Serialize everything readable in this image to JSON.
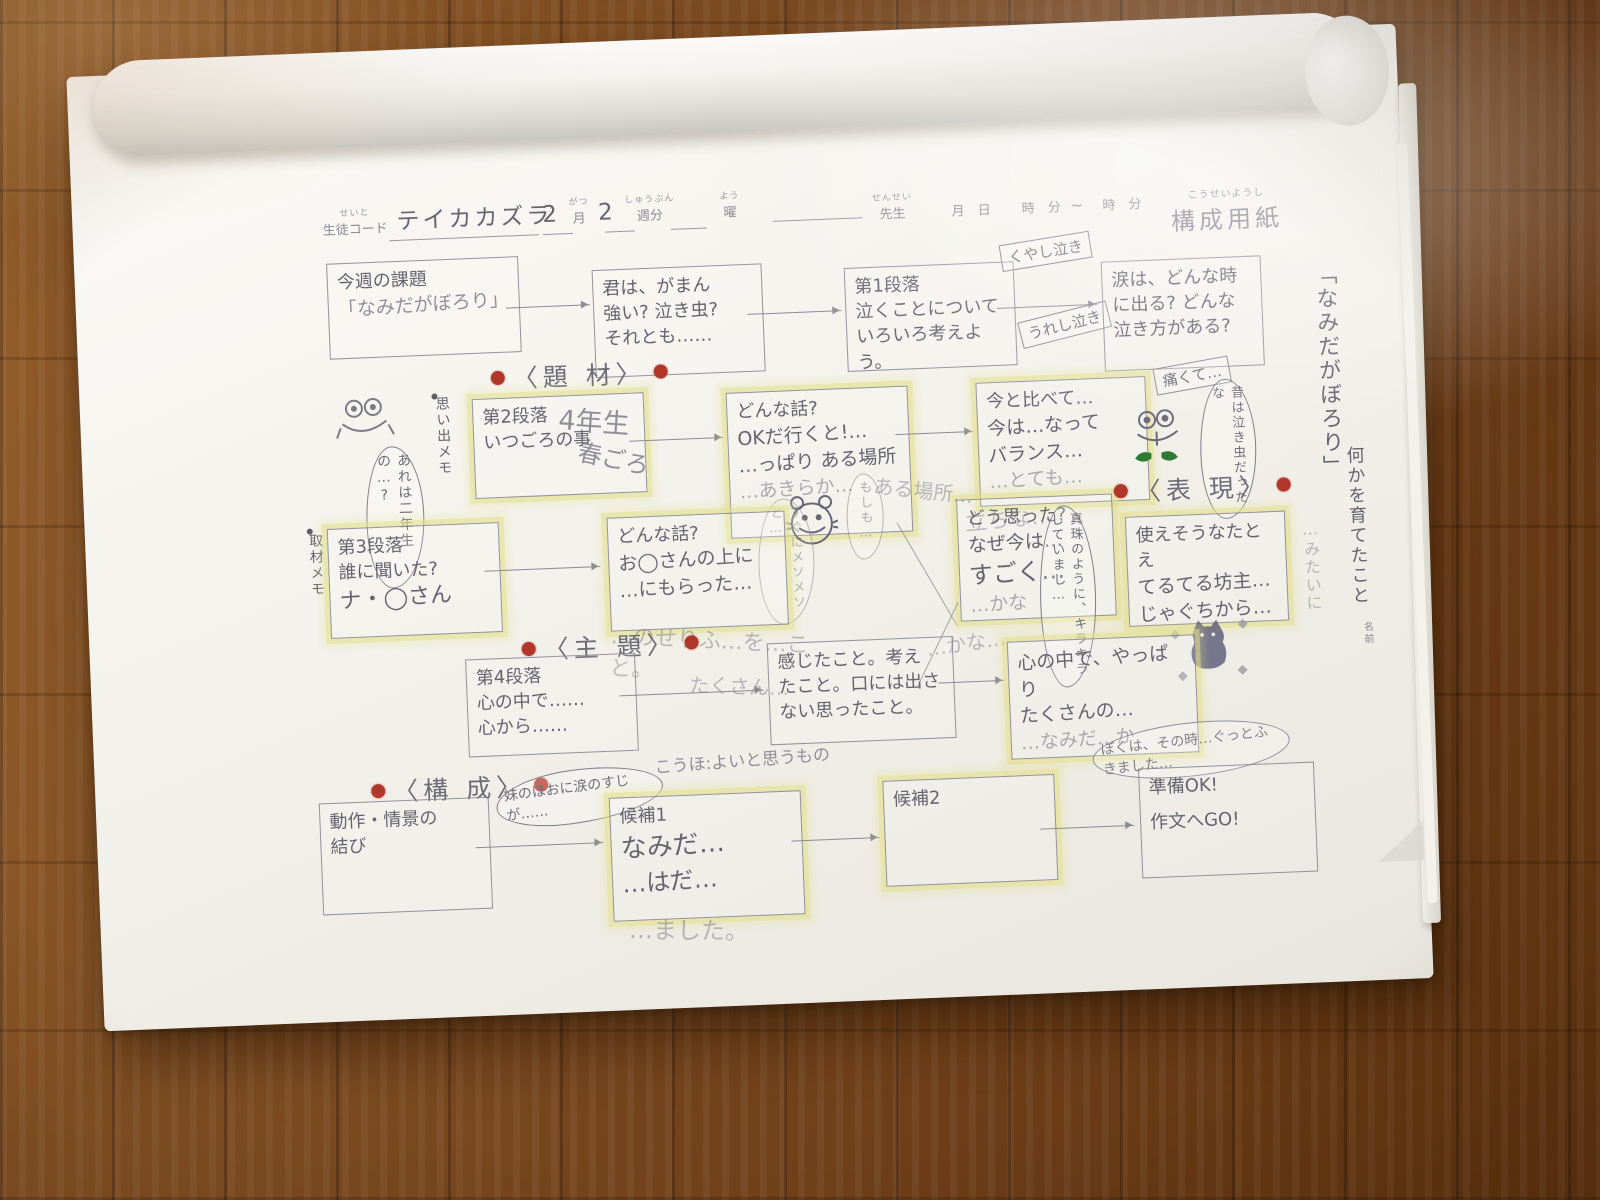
{
  "colors": {
    "highlight_yellow": "#e4e08c",
    "red_dot": "#b2372b",
    "pencil_gray": "#7e7e89",
    "pen_gray": "#64646f",
    "leaf_green": "#2f7a33",
    "cat_blue": "#5c5c78",
    "paper": "#f4f2ec",
    "wood": "#7c4a20"
  },
  "header": {
    "student_code_ruby": "せいと",
    "student_code_label": "生徒コード",
    "student_code_value": "テイカカズラ",
    "month_value": "2",
    "month_ruby": "がつ",
    "month_label": "月",
    "week_value": "2",
    "week_ruby": "しゅうぶん",
    "week_label": "週分",
    "day_ruby": "よう",
    "day_label": "曜",
    "teacher_ruby": "せんせい",
    "teacher_label": "先生",
    "m2_label": "月",
    "d2_label": "日",
    "h1_label": "時",
    "min1_label": "分",
    "tilde": "~",
    "h2_label": "時",
    "min2_label": "分",
    "sheet_title_ruby": "こうせいようし",
    "sheet_title": "構成用紙"
  },
  "sections": {
    "daizai": "〈題 材〉",
    "shudai": "〈主 題〉",
    "hyogen": "〈表 現〉",
    "kousei": "〈構 成〉"
  },
  "margins": {
    "omoide_memo": "思い出メモ",
    "shuzai_memo": "取材メモ",
    "title_vertical": "「なみだがぼろり」",
    "subtitle_vertical": "何かを育てたこと",
    "margin_pencil": "…みたいに",
    "name_label": "名前"
  },
  "boxes": {
    "b1": {
      "l1": "今週の課題",
      "l2": "「なみだがぼろり」"
    },
    "b2": {
      "l1": "君は、がまん",
      "l2": "強い? 泣き虫?",
      "l3": "それとも……"
    },
    "b3": {
      "l1": "第1段落",
      "l2": "泣くことについて",
      "l3": "いろいろ考えよう。"
    },
    "b4": {
      "l1": "涙は、どんな時",
      "l2": "に出る? どんな",
      "l3": "泣き方がある?"
    },
    "b5": {
      "l1": "第2段落",
      "l2": "いつごろの事",
      "p1": "4年生",
      "p2": "春ごろ"
    },
    "b6": {
      "l1": "どんな話?",
      "p1": "OKだ行くと!…",
      "p2": "…っぱり ある場所",
      "p3": "…あきらか…"
    },
    "b7": {
      "l1": "今と比べて…",
      "p1": "今は…なって",
      "p2": "バランス…",
      "p3": "…とても…",
      "under": "立ちな…"
    },
    "b8": {
      "l1": "第3段落",
      "l2": "誰に聞いた?",
      "p1": "ナ・◯さん"
    },
    "b9": {
      "l1": "どんな話?",
      "p1": "お◯さんの上に",
      "p2": "…にもらった…",
      "under": "…のせりふ…を…こと。"
    },
    "b10": {
      "l1": "どう思った?",
      "p1": "なぜ今は…",
      "p2": "すごく…",
      "p3": "…かな"
    },
    "b11": {
      "l1": "使えそうなたとえ",
      "p1": "てるてる坊主…",
      "p2": "じゃぐちから…"
    },
    "b12": {
      "l1": "第4段落",
      "l2": "心の中で……",
      "l3": "心から……"
    },
    "b13": {
      "l1": "感じたこと。考え",
      "l2": "たこと。口には出さ",
      "l3": "ない思ったこと。"
    },
    "b14": {
      "p1": "心の中で、やっぱり",
      "p2": "たくさんの…",
      "p3": "…なみだ…か"
    },
    "b15": {
      "l1": "動作・情景の",
      "l2": "結び"
    },
    "b16": {
      "l1": "候補1",
      "p1": "なみだ…",
      "p2": "…はだ…",
      "under": "…ました。"
    },
    "b17": {
      "l1": "候補2"
    },
    "b18": {
      "l1": "準備OK!",
      "l2": "作文へGO!"
    }
  },
  "tags": {
    "kuyashi": "くやし泣き",
    "ureshi": "うれし泣き",
    "itakute": "痛くて…"
  },
  "bubbles": {
    "arewa": "あれは二年生の…?",
    "mukashi": "昔は泣き虫だったな",
    "moshimo": "もしも…",
    "mesomeso": "すぐにメソメソと…",
    "shinju": "真珠のように、キラキラしていまし…",
    "boku": "ぼくは、その時…ぐっとふきました…",
    "imouto": "妹のほおに涙のすじが……",
    "kouho_note": "こうほ:よいと思うもの"
  },
  "stray": {
    "s1": "ある場所…",
    "s2": "…かな…",
    "s3": "たくさん…"
  }
}
